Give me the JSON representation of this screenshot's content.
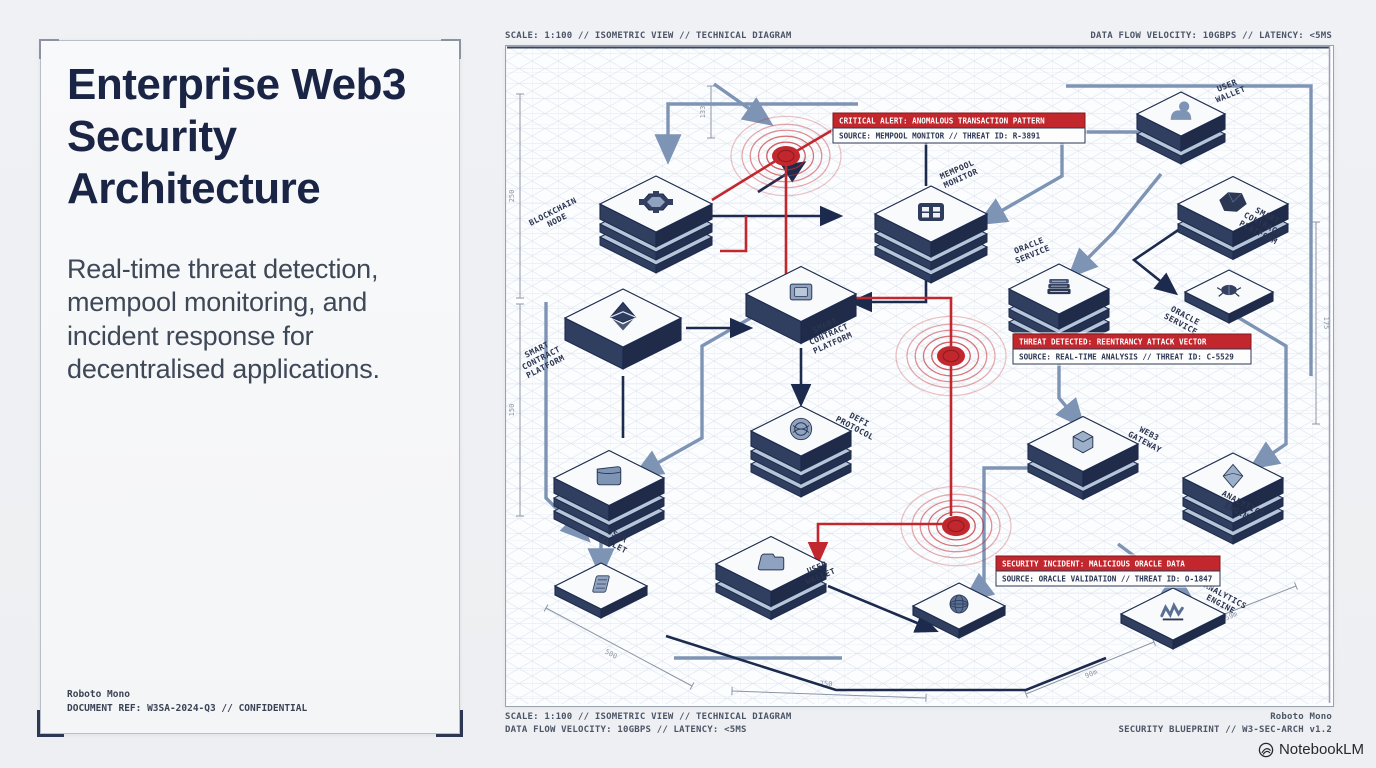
{
  "left_panel": {
    "title": "Enterprise Web3 Security Architecture",
    "subtitle": "Real-time threat detection, mempool monitoring, and incident response for decentralised applications.",
    "footer_line1": "Roboto Mono",
    "footer_line2": "DOCUMENT REF: W3SA-2024-Q3 // CONFIDENTIAL"
  },
  "captions": {
    "top_left": "SCALE: 1:100 // ISOMETRIC VIEW // TECHNICAL DIAGRAM",
    "top_right": "DATA FLOW VELOCITY: 10GBPS // LATENCY: <5MS",
    "bottom_left_line1": "SCALE: 1:100 // ISOMETRIC VIEW // TECHNICAL DIAGRAM",
    "bottom_left_line2": "DATA FLOW VELOCITY: 10GBPS // LATENCY: <5MS",
    "bottom_right_line1": "Roboto Mono",
    "bottom_right_line2": "SECURITY BLUEPRINT // W3-SEC-ARCH v1.2"
  },
  "brand": {
    "name": "NotebookLM"
  },
  "diagram": {
    "colors": {
      "navy": "#1c2b4d",
      "steel": "#7e94b4",
      "red": "#c1272d",
      "alert_header_bg": "#c1272d",
      "alert_body_bg": "#fdfdfd",
      "face_top": "#f9fafc",
      "face_left": "#303e60",
      "face_right": "#1f2b49",
      "slab_top": "#b7c5d9",
      "label": "#2b3550",
      "dim": "#8c95a6"
    },
    "nodes": [
      {
        "id": "user-wallet-top",
        "icon": "user-icon",
        "x": 675,
        "y": 68,
        "w": 44,
        "layers": 2
      },
      {
        "id": "blockchain-node",
        "icon": "hub-icon",
        "x": 150,
        "y": 158,
        "w": 56,
        "layers": 3
      },
      {
        "id": "smart-contract-platform-right",
        "icon": "polygon-icon",
        "x": 727,
        "y": 158,
        "w": 55,
        "layers": 2
      },
      {
        "id": "mempool-monitor",
        "icon": "grid-icon",
        "x": 425,
        "y": 168,
        "w": 56,
        "layers": 3
      },
      {
        "id": "oracle-service-mid",
        "icon": "docs-icon",
        "x": 553,
        "y": 243,
        "w": 50,
        "layers": 3
      },
      {
        "id": "oracle-service-right",
        "icon": "bug-icon",
        "x": 723,
        "y": 246,
        "w": 44,
        "layers": 1,
        "h": 9
      },
      {
        "id": "smart-contract-platform-mid",
        "icon": "chip-icon",
        "x": 295,
        "y": 248,
        "w": 55,
        "layers": 1,
        "h": 22
      },
      {
        "id": "smart-contract-platform-left",
        "icon": "eth-icon",
        "x": 117,
        "y": 272,
        "w": 58,
        "layers": 1,
        "h": 22
      },
      {
        "id": "defi-protocol",
        "icon": "emblem-icon",
        "x": 295,
        "y": 385,
        "w": 50,
        "layers": 3
      },
      {
        "id": "web3-gateway",
        "icon": "cube-icon",
        "x": 577,
        "y": 398,
        "w": 55,
        "layers": 2
      },
      {
        "id": "user-wallet-left",
        "icon": "wallet-icon",
        "x": 103,
        "y": 432,
        "w": 55,
        "layers": 3
      },
      {
        "id": "analytics-engine-right",
        "icon": "prism-icon",
        "x": 727,
        "y": 432,
        "w": 50,
        "layers": 3
      },
      {
        "id": "user-wallet-bottom",
        "icon": "folder-icon",
        "x": 265,
        "y": 518,
        "w": 55,
        "layers": 2
      },
      {
        "id": "ledger-node",
        "icon": "ledger-icon",
        "x": 95,
        "y": 540,
        "w": 46,
        "layers": 1,
        "h": 9
      },
      {
        "id": "globe-service",
        "icon": "globe-icon",
        "x": 453,
        "y": 560,
        "w": 46,
        "layers": 1,
        "h": 9
      },
      {
        "id": "analytics-engine-bottom",
        "icon": "chart-scribble-icon",
        "x": 667,
        "y": 568,
        "w": 52,
        "layers": 1,
        "h": 9
      }
    ],
    "labels": [
      {
        "text": "BLOCKCHAIN\nNODE",
        "x": 48,
        "y": 168,
        "rot": -27
      },
      {
        "text": "SMART\nCONTRACT\nPLATFORM",
        "x": 32,
        "y": 306,
        "rot": -27
      },
      {
        "text": "MEMPOOL\nMONITOR",
        "x": 452,
        "y": 126,
        "rot": -24
      },
      {
        "text": "ORACLE\nSERVICE",
        "x": 524,
        "y": 202,
        "rot": -22
      },
      {
        "text": "SMART\nCONTRACT\nPLATFORM",
        "x": 320,
        "y": 282,
        "rot": -24
      },
      {
        "text": "USER\nWALLET",
        "x": 722,
        "y": 42,
        "rot": -22
      },
      {
        "text": "SMART\nCONTRACT\nPLATFORM",
        "x": 760,
        "y": 172,
        "rot": 28
      },
      {
        "text": "ORACLE\nSERVICE",
        "x": 678,
        "y": 272,
        "rot": 28
      },
      {
        "text": "DEFI\nPROTOCOL",
        "x": 352,
        "y": 376,
        "rot": 28
      },
      {
        "text": "WEB3\nGATEWAY",
        "x": 642,
        "y": 390,
        "rot": 28
      },
      {
        "text": "USER\nWALLET",
        "x": 110,
        "y": 492,
        "rot": 28
      },
      {
        "text": "ANALYTICS\nENGINE",
        "x": 736,
        "y": 460,
        "rot": 28
      },
      {
        "text": "USER\nWALLET",
        "x": 312,
        "y": 524,
        "rot": -22
      },
      {
        "text": "ANALYTICS\nENGINE",
        "x": 718,
        "y": 552,
        "rot": 28
      }
    ],
    "pulses": [
      {
        "x": 280,
        "y": 110,
        "r": 55
      },
      {
        "x": 445,
        "y": 310,
        "r": 55
      },
      {
        "x": 450,
        "y": 480,
        "r": 55
      }
    ],
    "alerts": [
      {
        "x": 327,
        "y": 67,
        "w": 252,
        "title": "CRITICAL ALERT: ANOMALOUS TRANSACTION PATTERN",
        "source": "SOURCE: MEMPOOL MONITOR // THREAT ID: R-3891"
      },
      {
        "x": 507,
        "y": 288,
        "w": 238,
        "title": "THREAT DETECTED: REENTRANCY ATTACK VECTOR",
        "source": "SOURCE: REAL-TIME ANALYSIS // THREAT ID: C-5529"
      },
      {
        "x": 490,
        "y": 510,
        "w": 224,
        "title": "SECURITY INCIDENT: MALICIOUS ORACLE DATA",
        "source": "SOURCE: ORACLE VALIDATION // THREAT ID: O-1847"
      }
    ],
    "edges": [
      {
        "c": "steel",
        "a": true,
        "pts": [
          [
            640,
            86
          ],
          [
            556,
            86
          ],
          [
            556,
            130
          ],
          [
            476,
            176
          ]
        ]
      },
      {
        "c": "steel",
        "a": true,
        "pts": [
          [
            655,
            128
          ],
          [
            608,
            186
          ],
          [
            566,
            228
          ]
        ]
      },
      {
        "c": "steel",
        "a": true,
        "pts": [
          [
            553,
            268
          ],
          [
            553,
            352
          ],
          [
            575,
            378
          ]
        ]
      },
      {
        "c": "steel",
        "a": true,
        "pts": [
          [
            543,
            422
          ],
          [
            478,
            422
          ],
          [
            478,
            540
          ],
          [
            462,
            552
          ]
        ]
      },
      {
        "c": "steel",
        "a": true,
        "pts": [
          [
            262,
            262
          ],
          [
            196,
            300
          ],
          [
            196,
            392
          ],
          [
            132,
            428
          ]
        ]
      },
      {
        "c": "steel",
        "a": true,
        "pts": [
          [
            95,
            474
          ],
          [
            95,
            526
          ]
        ]
      },
      {
        "c": "steel",
        "a": true,
        "pts": [
          [
            612,
            498
          ],
          [
            682,
            550
          ]
        ]
      },
      {
        "c": "steel",
        "a": true,
        "pts": [
          [
            352,
            58
          ],
          [
            162,
            58
          ],
          [
            162,
            112
          ]
        ]
      },
      {
        "c": "steel",
        "a": true,
        "pts": [
          [
            723,
            266
          ],
          [
            780,
            300
          ],
          [
            780,
            398
          ],
          [
            748,
            420
          ]
        ]
      },
      {
        "c": "steel",
        "a": true,
        "pts": [
          [
            208,
            38
          ],
          [
            262,
            76
          ]
        ]
      },
      {
        "c": "steel",
        "a": true,
        "pts": [
          [
            40,
            256
          ],
          [
            40,
            452
          ],
          [
            80,
            492
          ]
        ]
      },
      {
        "c": "steel",
        "a": false,
        "pts": [
          [
            168,
            612
          ],
          [
            336,
            612
          ]
        ]
      },
      {
        "c": "steel",
        "a": false,
        "pts": [
          [
            560,
            40
          ],
          [
            805,
            40
          ],
          [
            805,
            330
          ]
        ]
      },
      {
        "c": "navy",
        "a": true,
        "pts": [
          [
            206,
            170
          ],
          [
            332,
            170
          ]
        ]
      },
      {
        "c": "navy",
        "a": true,
        "pts": [
          [
            180,
            282
          ],
          [
            242,
            282
          ]
        ]
      },
      {
        "c": "navy",
        "a": true,
        "pts": [
          [
            690,
            172
          ],
          [
            628,
            214
          ],
          [
            668,
            246
          ]
        ]
      },
      {
        "c": "navy",
        "a": true,
        "pts": [
          [
            420,
            226
          ],
          [
            420,
            256
          ],
          [
            348,
            256
          ]
        ]
      },
      {
        "c": "navy",
        "a": true,
        "pts": [
          [
            252,
            146
          ],
          [
            296,
            118
          ]
        ]
      },
      {
        "c": "navy",
        "a": true,
        "pts": [
          [
            295,
            302
          ],
          [
            295,
            356
          ]
        ]
      },
      {
        "c": "navy",
        "a": false,
        "pts": [
          [
            160,
            590
          ],
          [
            330,
            644
          ],
          [
            520,
            644
          ],
          [
            600,
            612
          ]
        ]
      },
      {
        "c": "navy",
        "a": true,
        "pts": [
          [
            322,
            540
          ],
          [
            428,
            584
          ]
        ]
      },
      {
        "c": "navy",
        "a": false,
        "pts": [
          [
            420,
            92
          ],
          [
            420,
            140
          ]
        ]
      },
      {
        "c": "navy",
        "a": false,
        "pts": [
          [
            117,
            330
          ],
          [
            117,
            392
          ]
        ]
      },
      {
        "c": "red",
        "a": false,
        "pts": [
          [
            280,
            118
          ],
          [
            280,
            252
          ],
          [
            445,
            252
          ],
          [
            445,
            300
          ]
        ]
      },
      {
        "c": "red",
        "a": false,
        "pts": [
          [
            445,
            320
          ],
          [
            445,
            470
          ]
        ]
      },
      {
        "c": "red",
        "a": true,
        "pts": [
          [
            443,
            478
          ],
          [
            312,
            478
          ],
          [
            312,
            514
          ]
        ]
      },
      {
        "c": "red",
        "a": false,
        "pts": [
          [
            271,
            114
          ],
          [
            206,
            154
          ]
        ]
      },
      {
        "c": "red",
        "a": false,
        "pts": [
          [
            289,
            106
          ],
          [
            330,
            82
          ]
        ]
      },
      {
        "c": "red",
        "a": false,
        "pts": [
          [
            240,
            170
          ],
          [
            240,
            205
          ],
          [
            214,
            205
          ]
        ]
      }
    ],
    "dimensions": [
      {
        "x1": 14,
        "y1": 48,
        "x2": 14,
        "y2": 252,
        "label": "250",
        "lx": 8,
        "ly": 150,
        "rot": -90
      },
      {
        "x1": 14,
        "y1": 258,
        "x2": 14,
        "y2": 470,
        "label": "150",
        "lx": 8,
        "ly": 364,
        "rot": -90
      },
      {
        "x1": 205,
        "y1": 40,
        "x2": 205,
        "y2": 92,
        "label": "133",
        "lx": 199,
        "ly": 66,
        "rot": -90
      },
      {
        "x1": 810,
        "y1": 176,
        "x2": 810,
        "y2": 378,
        "label": "175",
        "lx": 818,
        "ly": 277,
        "rot": 90
      },
      {
        "x1": 40,
        "y1": 562,
        "x2": 186,
        "y2": 640,
        "label": "500",
        "lx": 104,
        "ly": 610,
        "rot": 28
      },
      {
        "x1": 226,
        "y1": 645,
        "x2": 420,
        "y2": 652,
        "label": "750",
        "lx": 320,
        "ly": 640,
        "rot": 2
      },
      {
        "x1": 520,
        "y1": 648,
        "x2": 648,
        "y2": 596,
        "label": "90m",
        "lx": 586,
        "ly": 630,
        "rot": -23
      },
      {
        "x1": 658,
        "y1": 592,
        "x2": 790,
        "y2": 540,
        "label": "59m",
        "lx": 726,
        "ly": 572,
        "rot": -23
      }
    ]
  }
}
